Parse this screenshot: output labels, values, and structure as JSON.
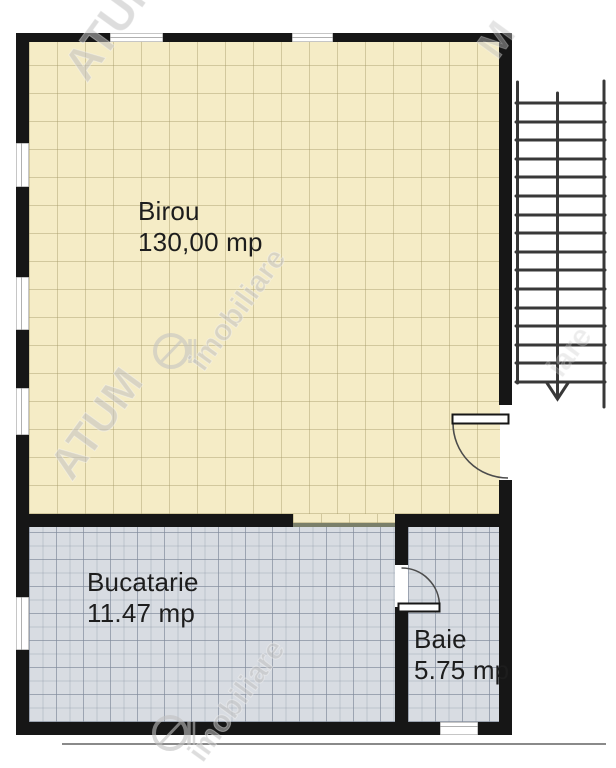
{
  "plan_title": "Floor plan",
  "rooms": {
    "birou": {
      "name": "Birou",
      "area": "130,00 mp"
    },
    "bucatarie": {
      "name": "Bucatarie",
      "area": "11.47 mp"
    },
    "baie": {
      "name": "Baie",
      "area": "5.75 mp"
    }
  },
  "stairs": {
    "direction": "down",
    "steps": 16
  },
  "watermark": {
    "brand": "ATUM",
    "brand_partial": "M",
    "company": "imobiliare",
    "company_partial": "iare"
  },
  "colors": {
    "office_fill": "#f5ecc6",
    "office_grid": "#c6bb90",
    "wet_fill": "#d8dce2",
    "wet_grid": "#9aa4b4",
    "wall": "#161616",
    "stair_stroke": "#383838",
    "door_arc": "#4c4c4c",
    "baseline": "#8a8a8a",
    "label_text": "#1d1d1d"
  }
}
